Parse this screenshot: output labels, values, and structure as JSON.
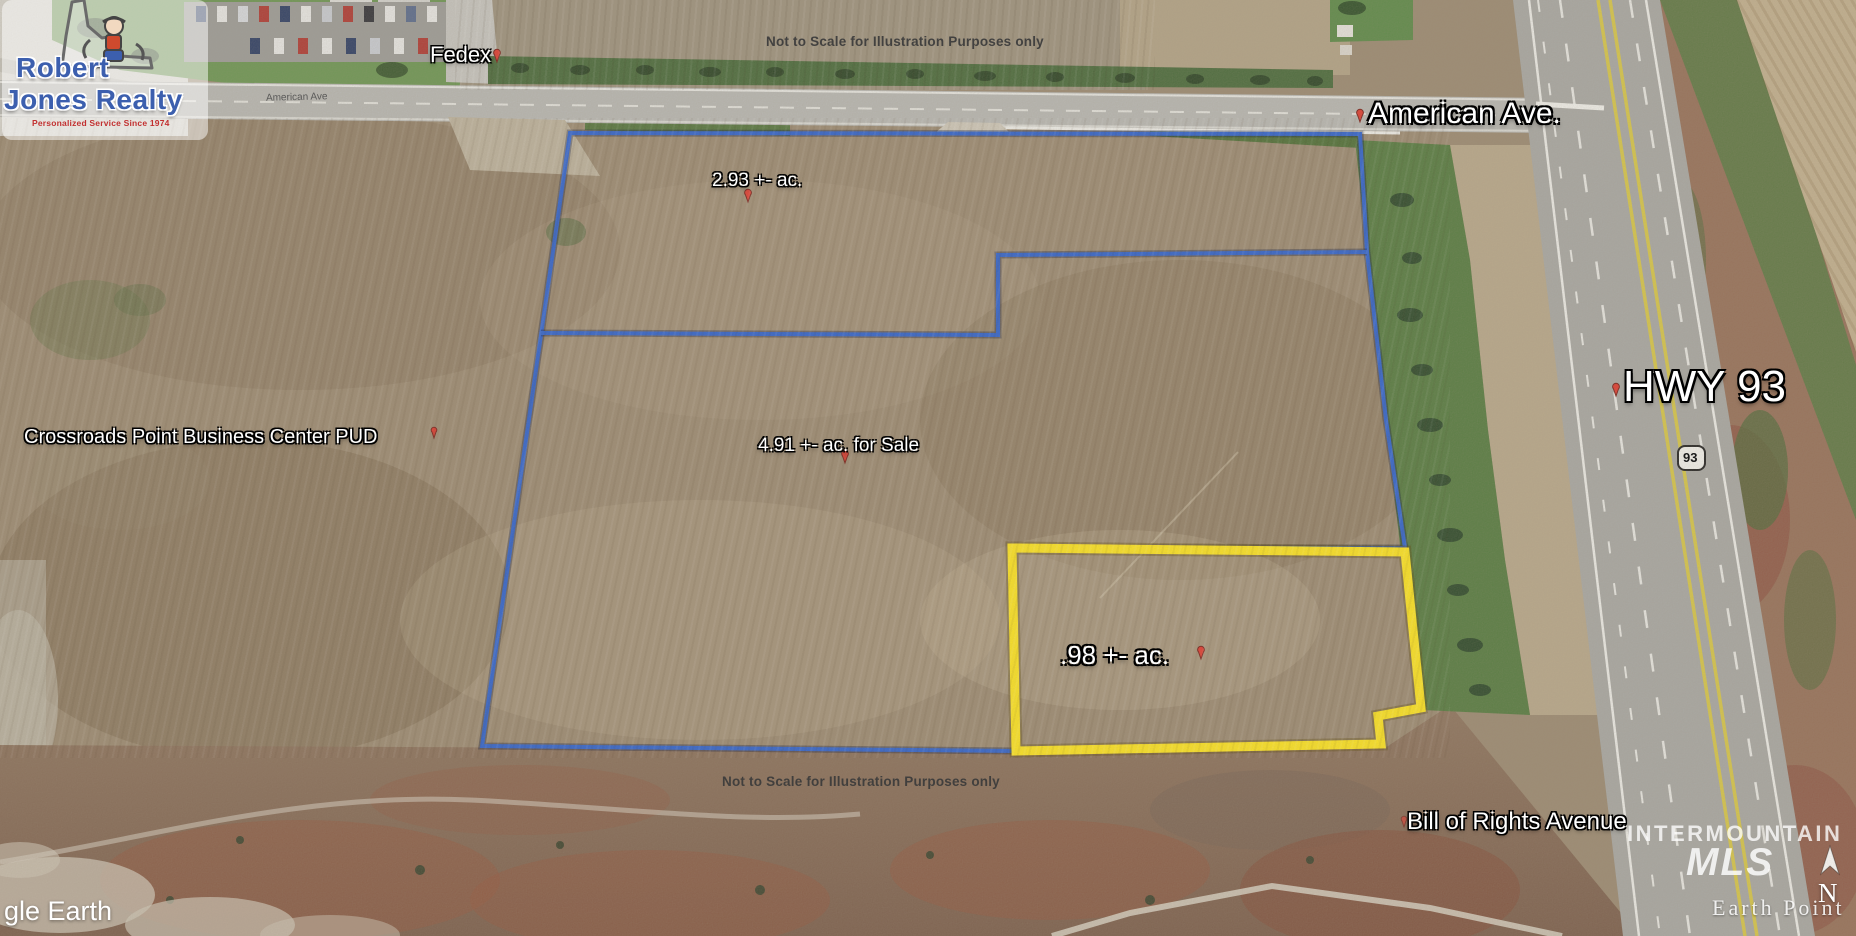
{
  "branding": {
    "realty_name_line1": "Robert",
    "realty_name_line2": "Jones Realty",
    "realty_tagline": "Personalized Service Since 1974"
  },
  "annotations": {
    "disclaimer_top": "Not to Scale for Illustration Purposes only",
    "disclaimer_bottom": "Not to Scale for Illustration Purposes only",
    "fedex": "Fedex",
    "american_ave_small": "American Ave",
    "american_ave": "American Ave.",
    "hwy_93": "HWY 93",
    "route_shield_93": "93",
    "crossroads_pud": "Crossroads Point Business Center PUD",
    "parcel_2_93": "2.93 +- ac.",
    "parcel_4_91": "4.91 +- ac. for Sale",
    "parcel_0_98": ".98 +- ac.",
    "bill_of_rights": "Bill of Rights Avenue"
  },
  "watermarks": {
    "google_earth_partial": "gle Earth",
    "mls_name": "INTERMOUNTAIN",
    "mls_abbrev": "MLS",
    "earth_point": "Earth Point",
    "north_indicator": "N"
  },
  "colors": {
    "parcel_outline_blue": "#2f63cf",
    "parcel_outline_yellow": "#ffe620",
    "pushpin_red": "#e03c31",
    "logo_blue": "#3c5fae",
    "logo_red": "#c23030"
  }
}
